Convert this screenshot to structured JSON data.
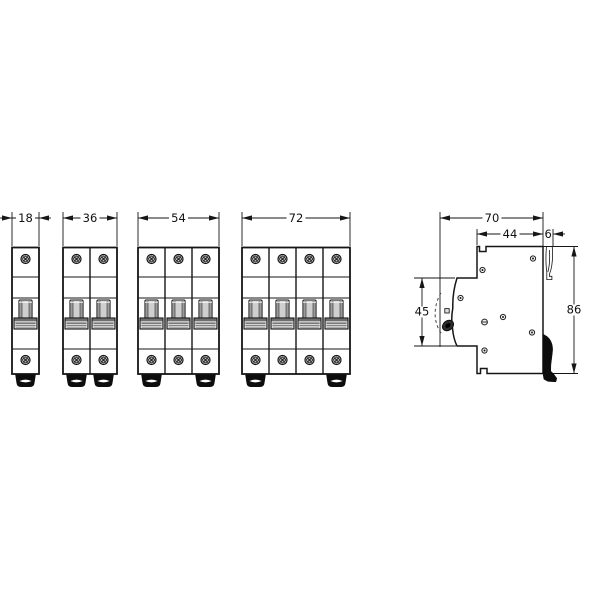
{
  "diagram": {
    "title": "miniature-circuit-breaker-dimension-drawing",
    "front_views": [
      {
        "poles": 1,
        "width_label": "18"
      },
      {
        "poles": 2,
        "width_label": "36"
      },
      {
        "poles": 3,
        "width_label": "54"
      },
      {
        "poles": 4,
        "width_label": "72"
      }
    ],
    "side_view": {
      "depth_label": "70",
      "body_depth_label": "44",
      "hook_label": "6",
      "front_height_label": "45",
      "height_label": "86"
    },
    "colors": {
      "line": "#161616",
      "toggle_dark": "#2e2e2e",
      "clip_black": "#0d0d0d",
      "metal_gray": "#c9c9c9"
    }
  }
}
